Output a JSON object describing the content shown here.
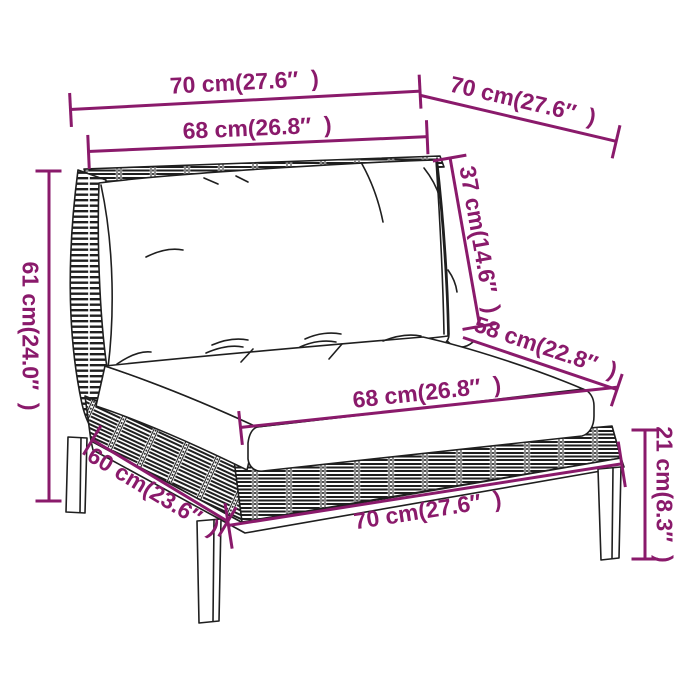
{
  "colors": {
    "accent": "#8a1a6b",
    "line_art": "#1f1f1f",
    "background": "#ffffff"
  },
  "dims": {
    "top_width": {
      "label": "70 cm(27.6″  )"
    },
    "top_depth": {
      "label": "70 cm(27.6″  )"
    },
    "back_width": {
      "label": "68 cm(26.8″  )"
    },
    "back_height": {
      "label": "37 cm(14.6″  )"
    },
    "seat_depth": {
      "label": "58 cm(22.8″  )"
    },
    "total_height": {
      "label": "61 cm(24.0″  )"
    },
    "base_depth": {
      "label": "60 cm(23.6″  )"
    },
    "seat_width": {
      "label": "68 cm(26.8″  )"
    },
    "base_width": {
      "label": "70 cm(27.6″  )"
    },
    "seat_height": {
      "label": "21 cm(8.3″  )"
    }
  }
}
